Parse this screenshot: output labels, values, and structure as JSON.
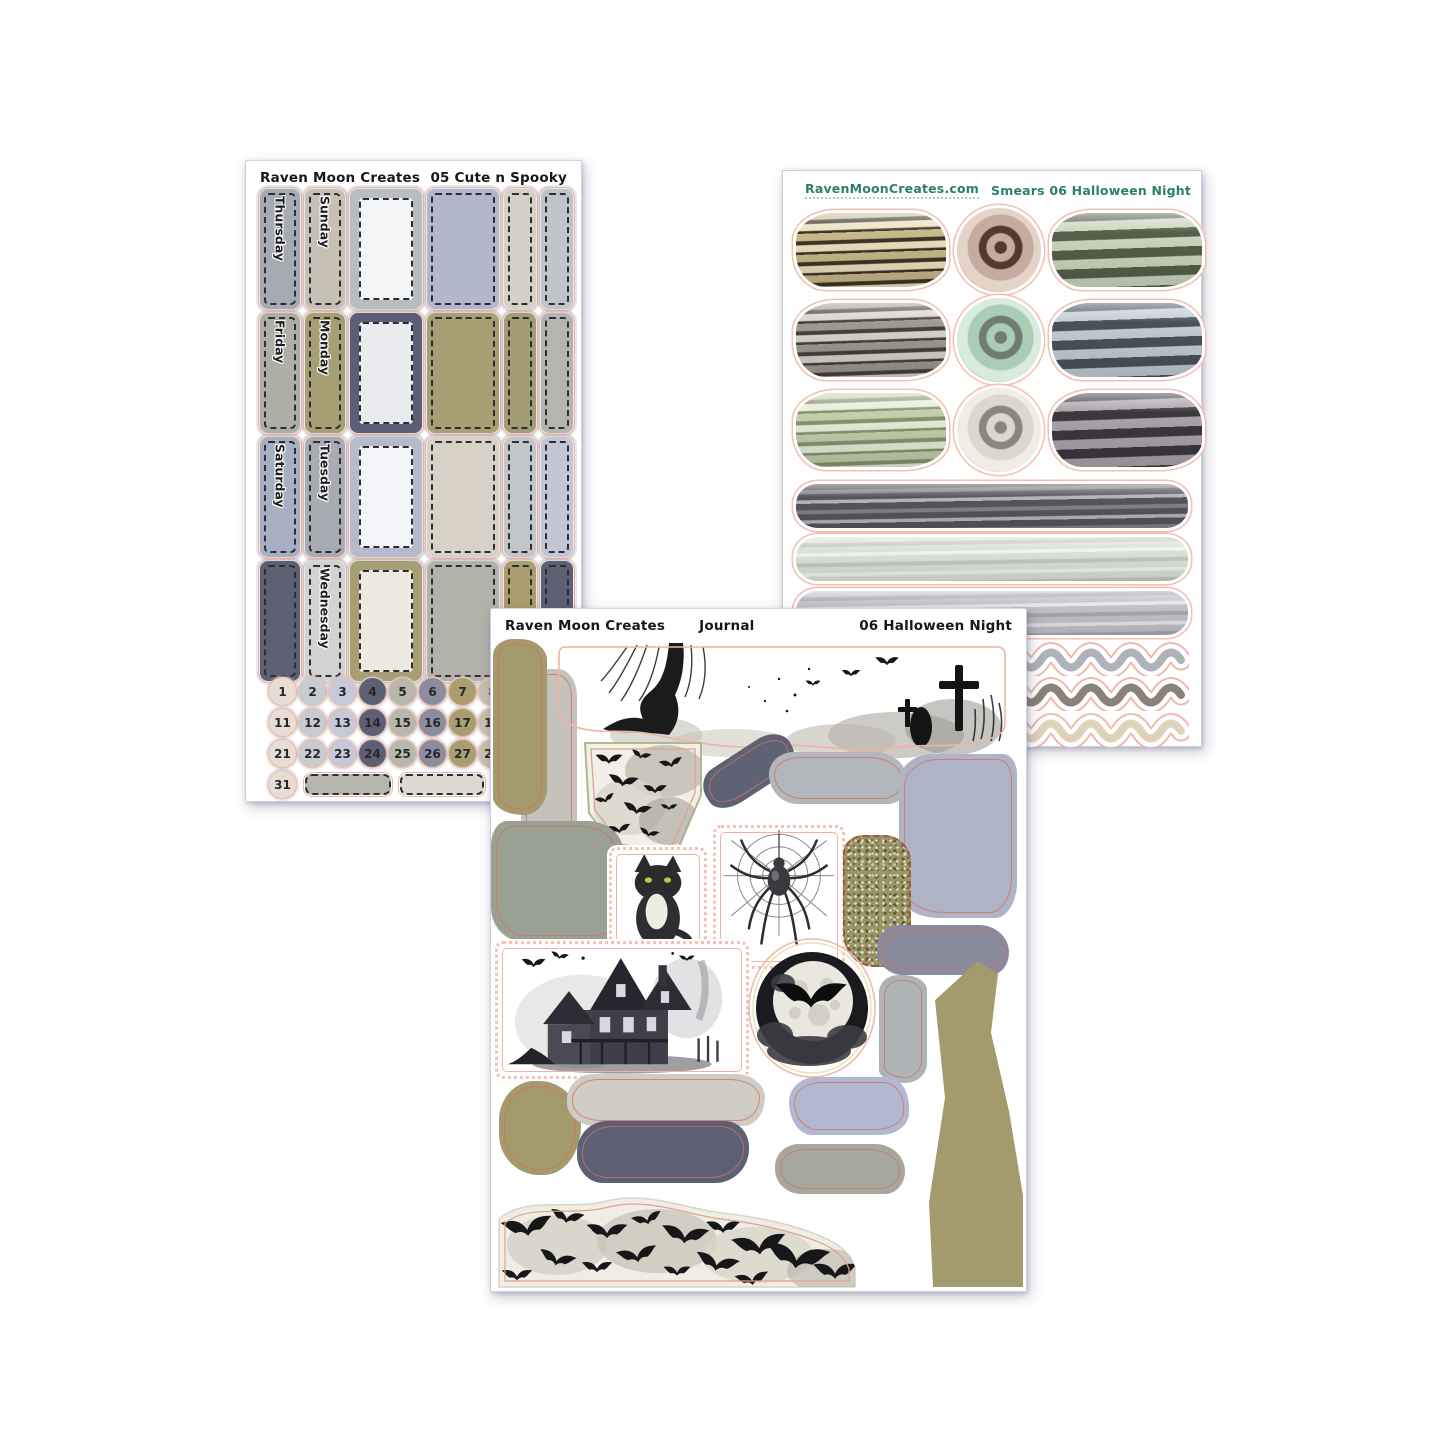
{
  "theme": {
    "ink": "#1b1b1d",
    "cutline": "#f0b4a3",
    "teal": "#2c7f6e",
    "paper": "#ffffff"
  },
  "sheet_cute_spooky": {
    "brand": "Raven Moon Creates",
    "code": "05 Cute n Spooky",
    "rows": [
      {
        "col1_label": "Thursday",
        "col1_color": "#a6aab1",
        "col2_label": "Sunday",
        "col2_color": "#c7c1b3",
        "col3_frame": "#b9bdc2",
        "col3_inner": "#f4f6f5",
        "col4_color": "#b2b7ca",
        "col5_color": "#d4d1c7",
        "col6_color": "#c0c5ca"
      },
      {
        "col1_label": "Friday",
        "col1_color": "#adafa7",
        "col2_label": "Monday",
        "col2_color": "#a79f73",
        "col3_frame": "#5b5e74",
        "col3_inner": "#e9ebee",
        "col4_color": "#a79f73",
        "col5_color": "#a49c74",
        "col6_color": "#b4b5b1"
      },
      {
        "col1_label": "Saturday",
        "col1_color": "#a9afc3",
        "col2_label": "Tuesday",
        "col2_color": "#a8acb2",
        "col3_frame": "#b5bacd",
        "col3_inner": "#f3f5f9",
        "col4_color": "#d7d2c5",
        "col5_color": "#c2c6c8",
        "col6_color": "#c2c6d5"
      },
      {
        "col1_label": "",
        "col1_color": "#5d6073",
        "col2_label": "Wednesday",
        "col2_color": "#d2d2d0",
        "col3_frame": "#a79f73",
        "col3_inner": "#edebe1",
        "col4_color": "#b2b2aa",
        "col5_color": "#aa9e6d",
        "col6_color": "#5d6073"
      }
    ],
    "dates": {
      "rows": [
        [
          1,
          2,
          3,
          4,
          5,
          6,
          7,
          8
        ],
        [
          11,
          12,
          13,
          14,
          15,
          16,
          17,
          18
        ],
        [
          21,
          22,
          23,
          24,
          25,
          26,
          27,
          28
        ],
        [
          31
        ]
      ],
      "column_colors": [
        "#e7ddd2",
        "#c8ccd0",
        "#c5c9da",
        "#5d5f72",
        "#b7b7aa",
        "#8c8c9f",
        "#aa9e70",
        "#c7bfae"
      ],
      "bottom_bars": [
        "#b4b5ab",
        "#dcd9d1",
        "#9fa3b8"
      ]
    }
  },
  "sheet_smears": {
    "logo_icon": "raven-icon",
    "site": "RavenMoonCreates.com",
    "label": "Smears 06 Halloween Night",
    "grid": [
      {
        "left_stack": [
          "#c8b98a",
          "#3e3426",
          "#ece0bd"
        ],
        "swirl": [
          "#c4ac9e",
          "#4f3b30",
          "#e4d4c8"
        ],
        "right_stack": [
          "#55604a",
          "#ccd6bc"
        ]
      },
      {
        "left_stack": [
          "#a09a90",
          "#46413b",
          "#d8d3cb"
        ],
        "swirl": [
          "#abcdb4",
          "#6f7d6f",
          "#d8ebdc"
        ],
        "right_stack": [
          "#49525c",
          "#c3ccd4"
        ]
      },
      {
        "left_stack": [
          "#c3cfad",
          "#87936f",
          "#e6edd9"
        ],
        "swirl": [
          "#dcd8cf",
          "#8b857d",
          "#f0ede6"
        ],
        "right_stack": [
          "#3c393e",
          "#aba3ab"
        ]
      }
    ],
    "long_smears": [
      [
        "#56555c",
        "#83828a",
        "#b5b4bb"
      ],
      [
        "#dce2d8",
        "#c2cabf",
        "#f0f4ee"
      ],
      [
        "#c4c3c8",
        "#a9a8ae",
        "#e8e7ec"
      ]
    ],
    "squiggles": [
      "#adb3b8",
      "#8a8177",
      "#ddd3ba"
    ]
  },
  "sheet_journal": {
    "brand": "Raven Moon Creates",
    "collection": "Journal",
    "code": "06 Halloween Night",
    "shapes": {
      "olive_strip_left": "#a39a6e",
      "gray_strip_left": "#c4c2bb",
      "slate_smear_1": "#5f6175",
      "gray_smear_1": "#b3b6ba",
      "lavender_big": "#aeb3c6",
      "graygreen_big": "#9aa092",
      "slate_smear_2": "#8a8a9d",
      "gray_vert_smear": "#b0b3b6",
      "olive_tall_strip": "#a39a6e",
      "olive_blob": "#a39a6e",
      "light_smear": "#cfccc6",
      "lavender_smear_2": "#b2b8d1",
      "darkslate_smear_2": "#5d6075",
      "graygreen_smear_2": "#a6a89e",
      "glitter_base": "#9a9468"
    }
  }
}
